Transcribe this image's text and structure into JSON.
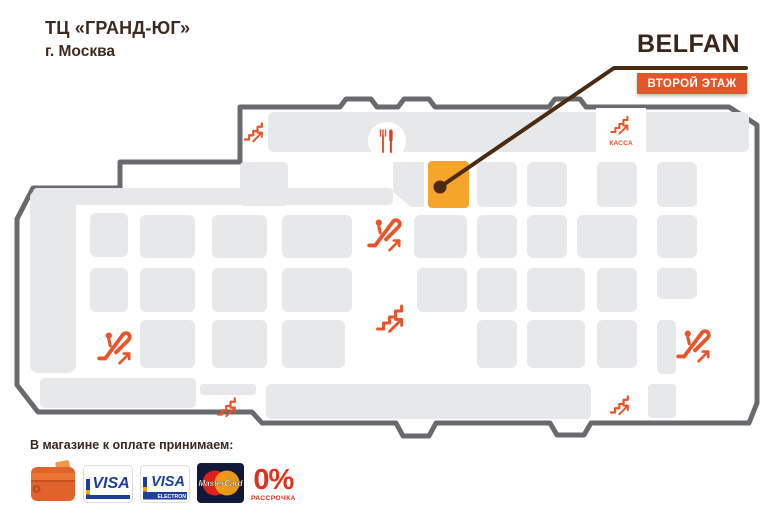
{
  "header": {
    "mall_title": "ТЦ «ГРАНД-ЮГ»",
    "city": "г. Москва"
  },
  "brand": {
    "logo_text": "BELFAN",
    "floor_badge": "ВТОРОЙ ЭТАЖ"
  },
  "colors": {
    "accent": "#E8552B",
    "knife": "#D5402A",
    "tile": "#E7E8EA",
    "outline": "#696A6D",
    "highlight": "#F6A42C",
    "callout": "#4A2B12",
    "title": "#3D2B1F",
    "badge": "#E4572B",
    "visa_blue": "#1E3E9C",
    "visa_yellow": "#F2A900",
    "mc_bg": "#101A38",
    "mc_red": "#DF1F1B",
    "mc_yellow": "#F4A41A",
    "installment_red": "#E2301F"
  },
  "map": {
    "cashier_label": "КАССА",
    "highlight_tile": {
      "x": 428,
      "y": 161,
      "w": 41,
      "h": 47
    },
    "callout": {
      "dot": [
        440,
        187
      ],
      "elbow": [
        614,
        68
      ],
      "end": [
        746,
        68
      ]
    },
    "tiles": [
      [
        268,
        112,
        481,
        40,
        6
      ],
      [
        33,
        188,
        360,
        17,
        4
      ],
      [
        240,
        162,
        48,
        44,
        4
      ],
      [
        30,
        190,
        46,
        183,
        8
      ],
      [
        90,
        213,
        38,
        44,
        6
      ],
      [
        140,
        215,
        55,
        43,
        6
      ],
      [
        212,
        215,
        55,
        43,
        6
      ],
      [
        282,
        215,
        70,
        43,
        6
      ],
      [
        90,
        268,
        38,
        44,
        6
      ],
      [
        140,
        268,
        55,
        44,
        6
      ],
      [
        212,
        268,
        55,
        44,
        6
      ],
      [
        282,
        268,
        70,
        44,
        6
      ],
      [
        140,
        320,
        55,
        48,
        6
      ],
      [
        212,
        320,
        55,
        48,
        6
      ],
      [
        282,
        320,
        63,
        48,
        6
      ],
      [
        477,
        162,
        40,
        45,
        6
      ],
      [
        527,
        162,
        40,
        45,
        6
      ],
      [
        597,
        162,
        40,
        45,
        6
      ],
      [
        657,
        162,
        40,
        45,
        6
      ],
      [
        414,
        215,
        53,
        43,
        6
      ],
      [
        477,
        215,
        40,
        43,
        6
      ],
      [
        527,
        215,
        40,
        43,
        6
      ],
      [
        577,
        215,
        60,
        43,
        6
      ],
      [
        657,
        215,
        40,
        43,
        6
      ],
      [
        417,
        268,
        50,
        44,
        6
      ],
      [
        477,
        268,
        40,
        44,
        6
      ],
      [
        527,
        268,
        58,
        44,
        6
      ],
      [
        597,
        268,
        40,
        44,
        6
      ],
      [
        657,
        268,
        40,
        31,
        6
      ],
      [
        477,
        320,
        40,
        48,
        6
      ],
      [
        527,
        320,
        58,
        48,
        6
      ],
      [
        597,
        320,
        40,
        48,
        6
      ],
      [
        657,
        320,
        19,
        54,
        5
      ],
      [
        40,
        378,
        156,
        30,
        5
      ],
      [
        200,
        384,
        56,
        11,
        3
      ],
      [
        266,
        384,
        325,
        35,
        5
      ],
      [
        648,
        384,
        28,
        34,
        4
      ]
    ],
    "cut_tile": "M393,162 L424,162 L424,207 L411,207 L393,192 Z",
    "cutouts": {
      "cashier_notch": [
        596,
        108,
        50,
        50
      ],
      "food_circle": [
        387,
        141,
        19
      ]
    },
    "markers": [
      {
        "type": "stairs",
        "x": 255,
        "y": 131,
        "s": 0.85
      },
      {
        "type": "food",
        "x": 387,
        "y": 141,
        "s": 1
      },
      {
        "type": "stairs",
        "x": 621,
        "y": 124,
        "s": 0.8,
        "label": "КАССА"
      },
      {
        "type": "escalator",
        "x": 386,
        "y": 231,
        "s": 1.2
      },
      {
        "type": "stairs",
        "x": 392,
        "y": 317,
        "s": 1.2
      },
      {
        "type": "escalator",
        "x": 116,
        "y": 344,
        "s": 1.2
      },
      {
        "type": "escalator",
        "x": 695,
        "y": 342,
        "s": 1.2
      },
      {
        "type": "stairs",
        "x": 228,
        "y": 406,
        "s": 0.85
      },
      {
        "type": "stairs",
        "x": 621,
        "y": 404,
        "s": 0.85
      }
    ]
  },
  "payments": {
    "label": "В магазине к оплате принимаем:",
    "methods": [
      {
        "name": "wallet"
      },
      {
        "name": "visa",
        "text": "VISA"
      },
      {
        "name": "visa-electron",
        "text": "VISA",
        "subtext": "ELECTRON"
      },
      {
        "name": "mastercard",
        "text": "MasterCard"
      },
      {
        "name": "installment",
        "text": "0%",
        "subtext": "РАССРОЧКА"
      }
    ]
  }
}
